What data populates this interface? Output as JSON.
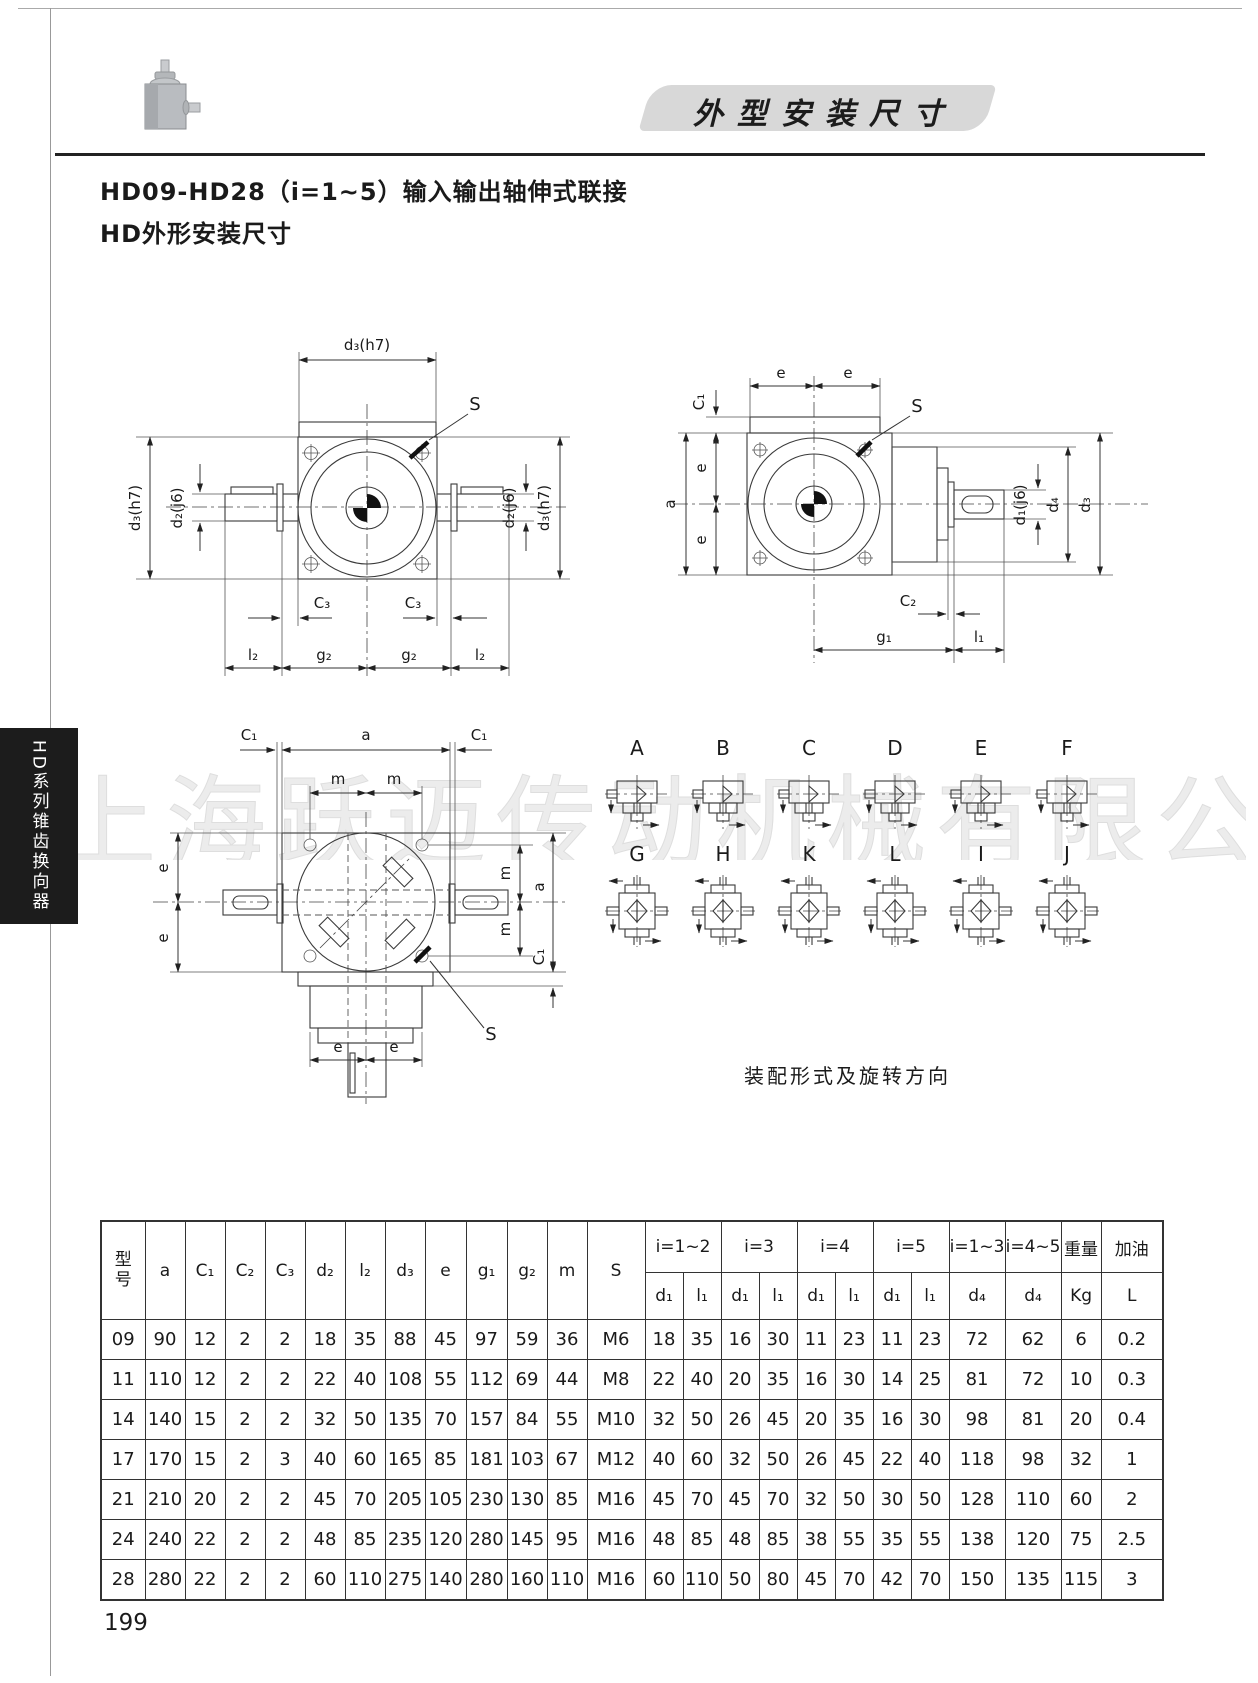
{
  "page": {
    "banner_title": "外型安装尺寸",
    "title_line1": "HD09-HD28（i=1~5）输入输出轴伸式联接",
    "title_line2": "HD外形安装尺寸",
    "sidebar_tab": "HD系列锥齿换向器",
    "watermark": "上海跃迈传动机械有限公司",
    "assembly_caption": "装配形式及旋转方向",
    "page_number": "199"
  },
  "colors": {
    "banner_bg": "#d8d8d8",
    "tab_bg": "#1c1c1c",
    "tab_text": "#ffffff",
    "line": "#333333",
    "watermark": "#ececec"
  },
  "front_view": {
    "labels": {
      "top": "d₃(h7)",
      "left": "d₃(h7)",
      "left_shaft": "d₂(j6)",
      "right_shaft": "d₂(j6)",
      "right_outer": "d₃(h7)",
      "s": "S",
      "c3_left": "C₃",
      "c3_right": "C₃",
      "l2_left": "l₂",
      "g2_left": "g₂",
      "g2_right": "g₂",
      "l2_right": "l₂"
    }
  },
  "side_view": {
    "labels": {
      "c1": "C₁",
      "e_top_left": "e",
      "e_top_right": "e",
      "s": "S",
      "a": "a",
      "e_left_upper": "e",
      "e_left_lower": "e",
      "d1": "d₁(j6)",
      "d4": "d₄",
      "d3": "d₃",
      "c2": "C₂",
      "g1": "g₁",
      "l1": "l₁"
    }
  },
  "top_view": {
    "labels": {
      "c1_left": "C₁",
      "a_top": "a",
      "c1_right": "C₁",
      "m_top_left": "m",
      "m_top_right": "m",
      "e_left_upper": "e",
      "e_left_lower": "e",
      "m_right_upper": "m",
      "m_right_lower": "m",
      "a_right": "a",
      "c1_bottom": "C₁",
      "e_bottom_left": "e",
      "e_bottom_right": "e",
      "s": "S"
    }
  },
  "assembly": {
    "row1": [
      "A",
      "B",
      "C",
      "D",
      "E",
      "F"
    ],
    "row2": [
      "G",
      "H",
      "K",
      "L",
      "I",
      "J"
    ]
  },
  "table": {
    "col_headers": [
      "型\n号",
      "a",
      "C₁",
      "C₂",
      "C₃",
      "d₂",
      "l₂",
      "d₃",
      "e",
      "g₁",
      "g₂",
      "m",
      "S"
    ],
    "group_headers": [
      "i=1~2",
      "i=3",
      "i=4",
      "i=5",
      "i=1~3",
      "i=4~5",
      "重量",
      "加油"
    ],
    "sub_headers": [
      "d₁",
      "l₁",
      "d₁",
      "l₁",
      "d₁",
      "l₁",
      "d₁",
      "l₁",
      "d₄",
      "d₄",
      "Kg",
      "L"
    ],
    "rows": [
      [
        "09",
        "90",
        "12",
        "2",
        "2",
        "18",
        "35",
        "88",
        "45",
        "97",
        "59",
        "36",
        "M6",
        "18",
        "35",
        "16",
        "30",
        "11",
        "23",
        "11",
        "23",
        "72",
        "62",
        "6",
        "0.2"
      ],
      [
        "11",
        "110",
        "12",
        "2",
        "2",
        "22",
        "40",
        "108",
        "55",
        "112",
        "69",
        "44",
        "M8",
        "22",
        "40",
        "20",
        "35",
        "16",
        "30",
        "14",
        "25",
        "81",
        "72",
        "10",
        "0.3"
      ],
      [
        "14",
        "140",
        "15",
        "2",
        "2",
        "32",
        "50",
        "135",
        "70",
        "157",
        "84",
        "55",
        "M10",
        "32",
        "50",
        "26",
        "45",
        "20",
        "35",
        "16",
        "30",
        "98",
        "81",
        "20",
        "0.4"
      ],
      [
        "17",
        "170",
        "15",
        "2",
        "3",
        "40",
        "60",
        "165",
        "85",
        "181",
        "103",
        "67",
        "M12",
        "40",
        "60",
        "32",
        "50",
        "26",
        "45",
        "22",
        "40",
        "118",
        "98",
        "32",
        "1"
      ],
      [
        "21",
        "210",
        "20",
        "2",
        "2",
        "45",
        "70",
        "205",
        "105",
        "230",
        "130",
        "85",
        "M16",
        "45",
        "70",
        "45",
        "70",
        "32",
        "50",
        "30",
        "50",
        "128",
        "110",
        "60",
        "2"
      ],
      [
        "24",
        "240",
        "22",
        "2",
        "2",
        "48",
        "85",
        "235",
        "120",
        "280",
        "145",
        "95",
        "M16",
        "48",
        "85",
        "48",
        "85",
        "38",
        "55",
        "35",
        "55",
        "138",
        "120",
        "75",
        "2.5"
      ],
      [
        "28",
        "280",
        "22",
        "2",
        "2",
        "60",
        "110",
        "275",
        "140",
        "280",
        "160",
        "110",
        "M16",
        "60",
        "110",
        "50",
        "80",
        "45",
        "70",
        "42",
        "70",
        "150",
        "135",
        "115",
        "3"
      ]
    ]
  }
}
